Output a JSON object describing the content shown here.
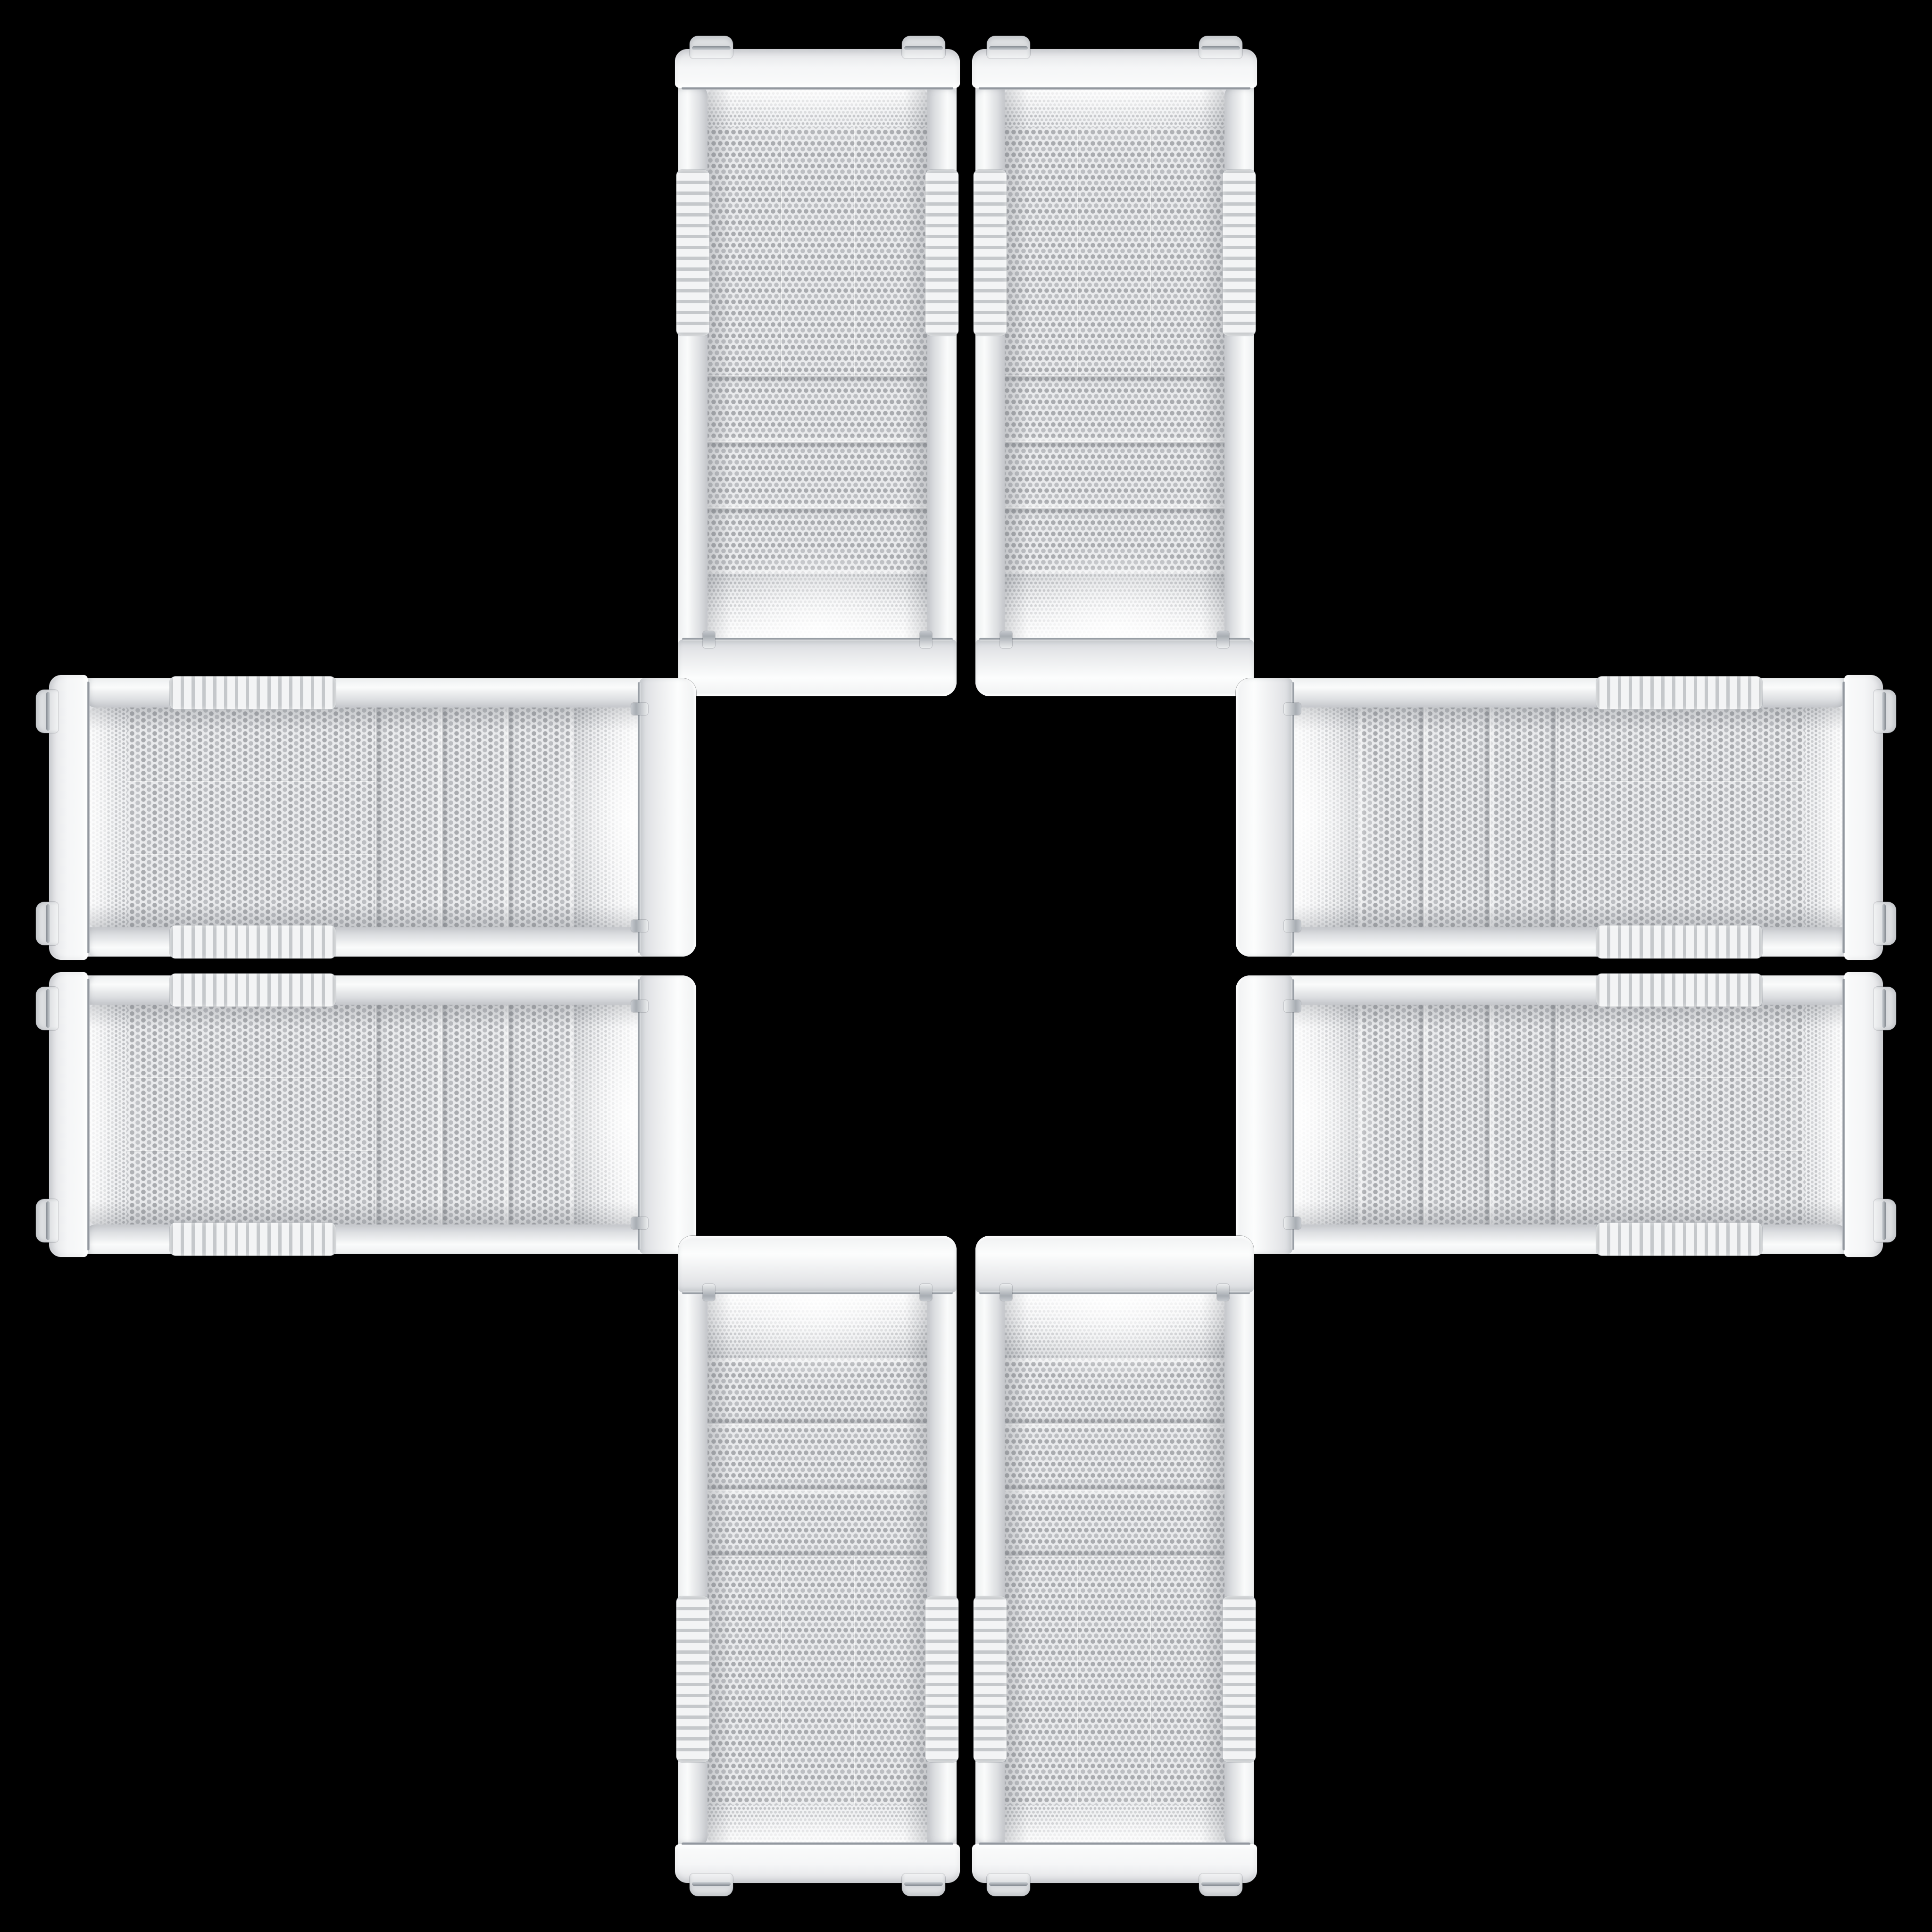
{
  "scene": {
    "type": "product-image-collage",
    "background_color": "#000000",
    "description": "Eight identical white Cooler Master mid-tower PC cases (front mesh panels) arranged in a symmetric cross / plus pattern on a black background, mirrored about both axes with an empty black square in the center",
    "product": "White Cooler Master mesh-front mid-tower PC case"
  },
  "brand": {
    "line1": "COOLER",
    "line2": "MASTER"
  },
  "colors": {
    "background": "#000000",
    "case_body": "#e8e9eb",
    "case_highlight": "#fafbfc",
    "case_shadow": "#c7c9cd",
    "mesh_background": "#e9eaec",
    "mesh_dot": "#a9abaf",
    "chrome_trim": "#969ca3",
    "badge_background": "#2e3033",
    "badge_border": "#8f9296",
    "badge_text": "#cfd1d4"
  },
  "cases": [
    {
      "id": "top-left",
      "orientation": "rotate-180"
    },
    {
      "id": "top-right",
      "orientation": "flip-vertical"
    },
    {
      "id": "left-top",
      "orientation": "rotate-90-flip-vertical"
    },
    {
      "id": "right-top",
      "orientation": "rotate-270"
    },
    {
      "id": "left-bottom",
      "orientation": "rotate-90"
    },
    {
      "id": "right-bottom",
      "orientation": "rotate-90-flip-horizontal"
    },
    {
      "id": "bottom-left",
      "orientation": "flip-horizontal"
    },
    {
      "id": "bottom-right",
      "orientation": "upright"
    }
  ]
}
